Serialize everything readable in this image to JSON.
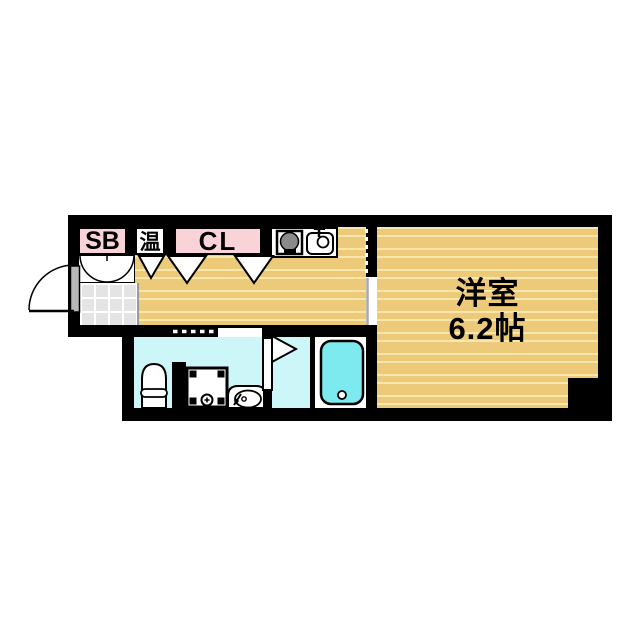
{
  "title": "apartment-floor-plan",
  "rooms": {
    "shoe_box_label": "SB",
    "water_heater_label": "温",
    "closet_label": "CL",
    "main_room_name": "洋室",
    "main_room_size": "6.2帖"
  },
  "colors": {
    "wall": "#000000",
    "flooring": "#ecca79",
    "flooring_stripe": "#f7e7ad",
    "storage_pink": "#f9d3d8",
    "wet_area_cyan": "#ccf6f8",
    "bathtub_cyan": "#7deaf0",
    "entrance_tile_grey": "#e4e4e4"
  },
  "icons": [
    "entry-door-icon",
    "shoe-box-doors-icon",
    "door-swing-icon",
    "stove-icon",
    "kitchen-sink-icon",
    "sliding-door-icon",
    "toilet-icon",
    "washing-machine-pan-icon",
    "wash-basin-icon",
    "folding-door-icon",
    "bathtub-icon",
    "pillar"
  ]
}
